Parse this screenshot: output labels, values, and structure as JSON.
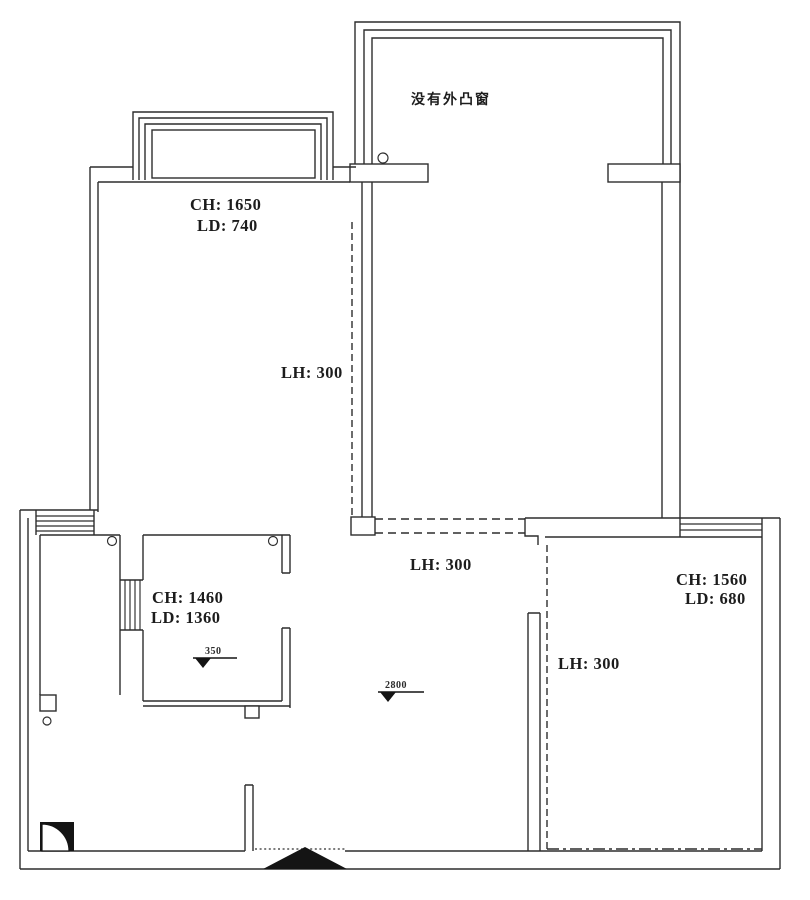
{
  "drawing": {
    "type": "floor-plan-survey",
    "colors": {
      "line": "#2d2d2d",
      "background": "#ffffff",
      "filled_symbols": "#141414"
    }
  },
  "labels": {
    "balcony_note": "没有外凸窗",
    "room_nw_ch": "CH: 1650",
    "room_nw_ld": "LD: 740",
    "lh_nw": "LH: 300",
    "lh_center": "LH: 300",
    "lh_se": "LH: 300",
    "bathroom_ch": "CH: 1460",
    "bathroom_ld": "LD: 1360",
    "room_se_ch": "CH: 1560",
    "room_se_ld": "LD: 680",
    "level_bathroom": "350",
    "level_hall": "2800"
  }
}
